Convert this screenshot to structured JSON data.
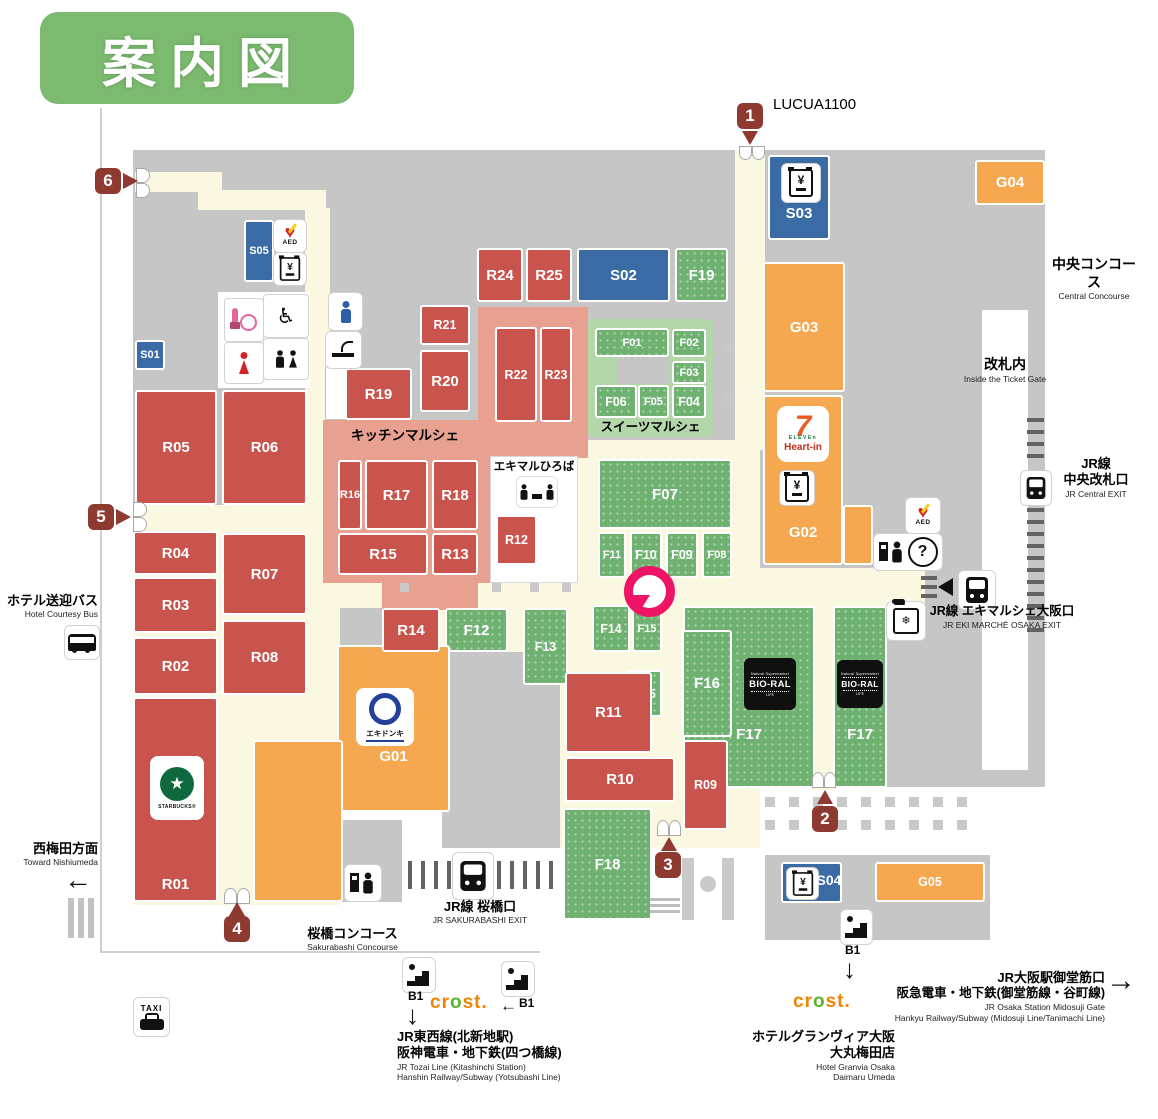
{
  "title": "案内図",
  "colors": {
    "red_store": "#c9544e",
    "green_store": "#6fb170",
    "blue_store": "#3b6ba5",
    "orange_store": "#f5a84f",
    "entrance_marker": "#8e3a31",
    "pin": "#ee1566",
    "title_bg": "#7cba70",
    "kitchen_area": "#e8a191",
    "sweets_area": "#b3d7a9",
    "walkway": "#fbf8e2",
    "floor": "#c6c6c6"
  },
  "stores": [
    {
      "id": "f17a",
      "label": "F17",
      "type": "green",
      "custom": true
    },
    {
      "id": "f17b",
      "label": "F17",
      "type": "green",
      "custom": true
    },
    {
      "id": "f16",
      "label": "F16",
      "type": "green"
    },
    {
      "id": "f19",
      "label": "F19",
      "type": "green"
    },
    {
      "id": "f01",
      "label": "F01",
      "type": "green"
    },
    {
      "id": "f02",
      "label": "F02",
      "type": "green"
    },
    {
      "id": "f03",
      "label": "F03",
      "type": "green"
    },
    {
      "id": "f04",
      "label": "F04",
      "type": "green"
    },
    {
      "id": "f05",
      "label": "F05",
      "type": "green"
    },
    {
      "id": "f06",
      "label": "F06",
      "type": "green"
    },
    {
      "id": "f07",
      "label": "F07",
      "type": "green"
    },
    {
      "id": "f08",
      "label": "F08",
      "type": "green"
    },
    {
      "id": "f09",
      "label": "F09",
      "type": "green"
    },
    {
      "id": "f10",
      "label": "F10",
      "type": "green"
    },
    {
      "id": "f11",
      "label": "F11",
      "type": "green"
    },
    {
      "id": "f12",
      "label": "F12",
      "type": "green"
    },
    {
      "id": "f13",
      "label": "F13",
      "type": "green"
    },
    {
      "id": "f14",
      "label": "F14",
      "type": "green"
    },
    {
      "id": "f15",
      "label": "F15",
      "type": "green"
    },
    {
      "id": "f15b",
      "label": "F15",
      "type": "green"
    },
    {
      "id": "f18",
      "label": "F18",
      "type": "green"
    },
    {
      "id": "s01",
      "label": "S01",
      "type": "blue"
    },
    {
      "id": "s02",
      "label": "S02",
      "type": "blue"
    },
    {
      "id": "s03",
      "label": "S03",
      "type": "blue",
      "custom": true
    },
    {
      "id": "s04",
      "label": "S04",
      "type": "blue",
      "custom": true
    },
    {
      "id": "s05",
      "label": "S05",
      "type": "blue"
    },
    {
      "id": "g03",
      "label": "G03",
      "type": "orange"
    },
    {
      "id": "g04",
      "label": "G04",
      "type": "orange"
    },
    {
      "id": "g05",
      "label": "G05",
      "type": "orange"
    },
    {
      "id": "g02",
      "label": "G02",
      "type": "orange",
      "custom": true
    },
    {
      "id": "g02b",
      "label": "",
      "type": "orange",
      "custom": true
    },
    {
      "id": "g01a",
      "label": "G01",
      "type": "orange",
      "custom": true
    },
    {
      "id": "g01b",
      "label": "",
      "type": "orange",
      "custom": true
    },
    {
      "id": "r24",
      "label": "R24",
      "type": "red"
    },
    {
      "id": "r25",
      "label": "R25",
      "type": "red"
    },
    {
      "id": "r21",
      "label": "R21",
      "type": "red"
    },
    {
      "id": "r20",
      "label": "R20",
      "type": "red"
    },
    {
      "id": "r19",
      "label": "R19",
      "type": "red"
    },
    {
      "id": "r22",
      "label": "R22",
      "type": "red"
    },
    {
      "id": "r23",
      "label": "R23",
      "type": "red"
    },
    {
      "id": "r05",
      "label": "R05",
      "type": "red"
    },
    {
      "id": "r06",
      "label": "R06",
      "type": "red"
    },
    {
      "id": "r16",
      "label": "R16",
      "type": "red"
    },
    {
      "id": "r17",
      "label": "R17",
      "type": "red"
    },
    {
      "id": "r18",
      "label": "R18",
      "type": "red"
    },
    {
      "id": "r15",
      "label": "R15",
      "type": "red"
    },
    {
      "id": "r13",
      "label": "R13",
      "type": "red"
    },
    {
      "id": "r12",
      "label": "R12",
      "type": "red"
    },
    {
      "id": "r14",
      "label": "R14",
      "type": "red"
    },
    {
      "id": "r04",
      "label": "R04",
      "type": "red"
    },
    {
      "id": "r03",
      "label": "R03",
      "type": "red"
    },
    {
      "id": "r02",
      "label": "R02",
      "type": "red"
    },
    {
      "id": "r07",
      "label": "R07",
      "type": "red"
    },
    {
      "id": "r08",
      "label": "R08",
      "type": "red"
    },
    {
      "id": "r01",
      "label": "R01",
      "type": "red",
      "custom": true
    },
    {
      "id": "r11",
      "label": "R11",
      "type": "red"
    },
    {
      "id": "r10",
      "label": "R10",
      "type": "red"
    },
    {
      "id": "r09",
      "label": "R09",
      "type": "red"
    }
  ],
  "overlays": {
    "r01": "R01",
    "g01": "G01",
    "g02": "G02",
    "f17": "F17",
    "s03": "S03",
    "s04": "S04"
  },
  "areas": {
    "kitchen_marche": "キッチンマルシェ",
    "sweets_marche": "スイーツマルシェ",
    "ekimaru_hiroba": "エキマルひろば"
  },
  "entrances": [
    "1",
    "2",
    "3",
    "4",
    "5",
    "6"
  ],
  "labels": {
    "lucua": "LUCUA1100",
    "central_concourse": {
      "jp": "中央コンコース",
      "en": "Central Concourse"
    },
    "inside_gate": {
      "jp": "改札内",
      "en": "Inside the Ticket Gate"
    },
    "jr_central_exit": {
      "jp1": "JR線",
      "jp2": "中央改札口",
      "en": "JR Central EXIT"
    },
    "ekimarche_exit": {
      "jp": "JR線 エキマルシェ大阪口",
      "en": "JR EKI MARCHÉ OSAKA EXIT"
    },
    "hotel_bus": {
      "jp": "ホテル送迎バス",
      "en": "Hotel Courtesy Bus"
    },
    "nishiumeda": {
      "jp": "西梅田方面",
      "en": "Toward Nishiumeda"
    },
    "sakurabashi_exit": {
      "jp": "JR線 桜橋口",
      "en": "JR SAKURABASHI EXIT"
    },
    "sakurabashi_concourse": {
      "jp": "桜橋コンコース",
      "en": "Sakurabashi Concourse"
    },
    "tozai": {
      "jp1": "JR東西線(北新地駅)",
      "jp2": "阪神電車・地下鉄(四つ橋線)",
      "en1": "JR Tozai Line (Kitashinchi Station)",
      "en2": "Hanshin Railway/Subway (Yotsubashi Line)"
    },
    "granvia": {
      "jp1": "ホテルグランヴィア大阪",
      "jp2": "大丸梅田店",
      "en1": "Hotel Granvia Osaka",
      "en2": "Daimaru Umeda"
    },
    "midosuji": {
      "jp1": "JR大阪駅御堂筋口",
      "jp2": "阪急電車・地下鉄(御堂筋線・谷町線)",
      "en1": "JR Osaka Station Midosuji Gate",
      "en2": "Hankyu Railway/Subway (Midosuji Line/Tanimachi Line)"
    },
    "b1": "B1"
  },
  "logos": {
    "starbucks": "STARBUCKS®",
    "bioral": "BIO-RAL",
    "bioral_top": "Natural Supermarket",
    "bioral_bottom": "LIFE",
    "seven": "7",
    "eleven": "ELEVEn",
    "heart_in": "Heart-in",
    "ekidonki": "エキドンキ",
    "crost": "crost."
  },
  "icons": {
    "aed": "AED",
    "taxi": "TAXI",
    "atm": "¥",
    "info": "?"
  }
}
